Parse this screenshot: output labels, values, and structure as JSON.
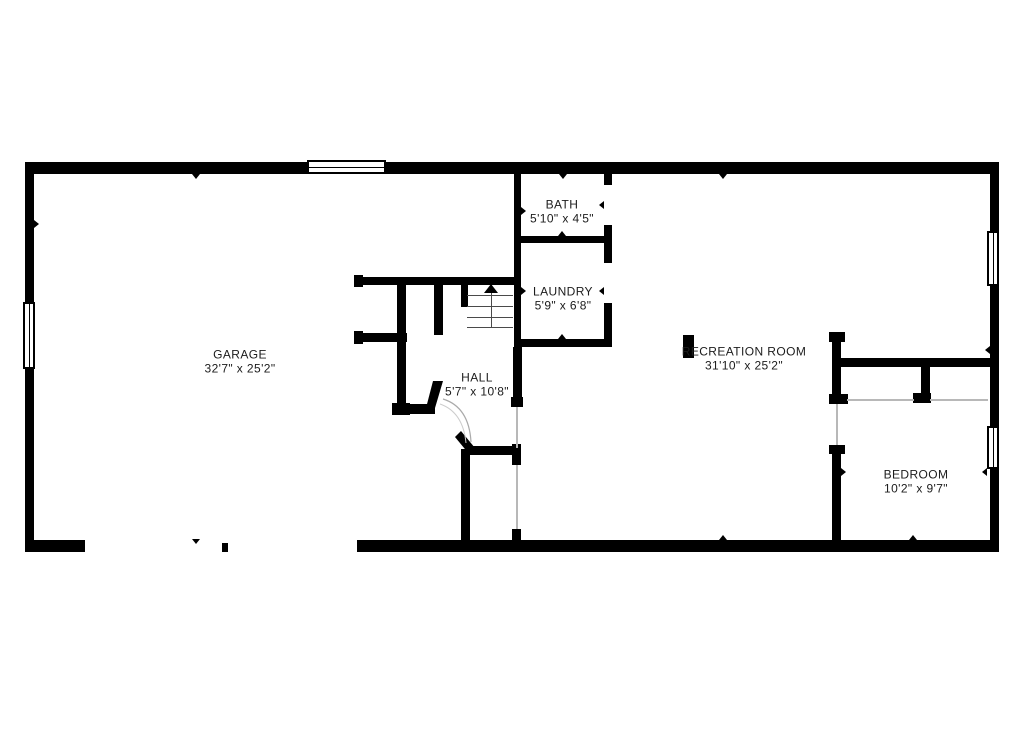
{
  "plan": {
    "type": "floor-plan",
    "bg_color": "#ffffff",
    "wall_color": "#000000",
    "text_color": "#1c1c1c",
    "rooms": [
      {
        "id": "garage",
        "name": "GARAGE",
        "dims": "32'7\" x 25'2\"",
        "cx": 240,
        "cy": 362
      },
      {
        "id": "bath",
        "name": "BATH",
        "dims": "5'10\" x 4'5\"",
        "cx": 562,
        "cy": 212
      },
      {
        "id": "laundry",
        "name": "LAUNDRY",
        "dims": "5'9\" x 6'8\"",
        "cx": 563,
        "cy": 299
      },
      {
        "id": "hall",
        "name": "HALL",
        "dims": "5'7\" x 10'8\"",
        "cx": 477,
        "cy": 385
      },
      {
        "id": "recreation-room",
        "name": "RECREATION ROOM",
        "dims": "31'10\" x 25'2\"",
        "cx": 744,
        "cy": 359
      },
      {
        "id": "bedroom",
        "name": "BEDROOM",
        "dims": "10'2\" x 9'7\"",
        "cx": 916,
        "cy": 482
      }
    ],
    "walls": [
      [
        25,
        162,
        974,
        12
      ],
      [
        25,
        162,
        9,
        390
      ],
      [
        990,
        162,
        9,
        390
      ],
      [
        25,
        540,
        60,
        12
      ],
      [
        357,
        540,
        642,
        12
      ],
      [
        222,
        543,
        6,
        9
      ],
      [
        514,
        174,
        7,
        173
      ],
      [
        514,
        236,
        98,
        7
      ],
      [
        604,
        174,
        8,
        11
      ],
      [
        604,
        225,
        8,
        38
      ],
      [
        604,
        303,
        8,
        44
      ],
      [
        514,
        339,
        98,
        8
      ],
      [
        354,
        275,
        9,
        12
      ],
      [
        355,
        277,
        166,
        8
      ],
      [
        354,
        331,
        9,
        13
      ],
      [
        355,
        333,
        52,
        9
      ],
      [
        397,
        285,
        9,
        120
      ],
      [
        392,
        403,
        18,
        12
      ],
      [
        434,
        285,
        9,
        50
      ],
      [
        395,
        404,
        40,
        10
      ],
      [
        461,
        285,
        7,
        22
      ],
      [
        513,
        347,
        9,
        50
      ],
      [
        511,
        397,
        12,
        10
      ],
      [
        461,
        449,
        9,
        103
      ],
      [
        470,
        446,
        45,
        9
      ],
      [
        512,
        444,
        9,
        21
      ],
      [
        512,
        529,
        9,
        23
      ],
      [
        683,
        335,
        11,
        23
      ],
      [
        829,
        332,
        16,
        10
      ],
      [
        832,
        332,
        9,
        72
      ],
      [
        829,
        394,
        19,
        10
      ],
      [
        841,
        358,
        149,
        9
      ],
      [
        921,
        367,
        9,
        36
      ],
      [
        913,
        393,
        18,
        10
      ],
      [
        829,
        445,
        16,
        9
      ],
      [
        832,
        445,
        9,
        107
      ]
    ],
    "windows": [
      {
        "x": 307,
        "y": 160,
        "w": 79,
        "h": 14,
        "orient": "h"
      },
      {
        "x": 23,
        "y": 302,
        "w": 12,
        "h": 67,
        "orient": "v"
      },
      {
        "x": 987,
        "y": 231,
        "w": 12,
        "h": 55,
        "orient": "v"
      },
      {
        "x": 987,
        "y": 426,
        "w": 12,
        "h": 43,
        "orient": "v"
      }
    ],
    "openings": [
      [
        836,
        404,
        2,
        41
      ],
      [
        516,
        407,
        2,
        41
      ],
      [
        516,
        465,
        2,
        64
      ],
      [
        847,
        399,
        67,
        2
      ],
      [
        930,
        399,
        58,
        2
      ]
    ],
    "markers": [
      {
        "x": 196,
        "y": 174,
        "dir": "down"
      },
      {
        "x": 563,
        "y": 174,
        "dir": "down"
      },
      {
        "x": 723,
        "y": 174,
        "dir": "down"
      },
      {
        "x": 34,
        "y": 224,
        "dir": "right"
      },
      {
        "x": 521,
        "y": 211,
        "dir": "right"
      },
      {
        "x": 604,
        "y": 205,
        "dir": "left"
      },
      {
        "x": 562,
        "y": 236,
        "dir": "up"
      },
      {
        "x": 521,
        "y": 291,
        "dir": "right"
      },
      {
        "x": 604,
        "y": 291,
        "dir": "left"
      },
      {
        "x": 562,
        "y": 339,
        "dir": "up"
      },
      {
        "x": 990,
        "y": 350,
        "dir": "left"
      },
      {
        "x": 841,
        "y": 472,
        "dir": "right"
      },
      {
        "x": 987,
        "y": 472,
        "dir": "left"
      },
      {
        "x": 723,
        "y": 540,
        "dir": "up"
      },
      {
        "x": 913,
        "y": 540,
        "dir": "up"
      },
      {
        "x": 196,
        "y": 539,
        "dir": "down"
      }
    ],
    "stairs": {
      "x1": 467,
      "x2": 513,
      "top": 285,
      "treads": [
        295,
        306,
        317,
        327
      ],
      "center_x": 491,
      "arrow_x": 484,
      "arrow_y": 284
    },
    "diagonals": {
      "bevel_corner": "433,381 443,381 435,408 426,408",
      "door_leaf": "455,437 461,431 475,448 469,454",
      "door_arc_outer": "M 443 399 Q 469 407 471 442",
      "door_arc_inner": "M 440 404 Q 463 412 466 443"
    }
  }
}
